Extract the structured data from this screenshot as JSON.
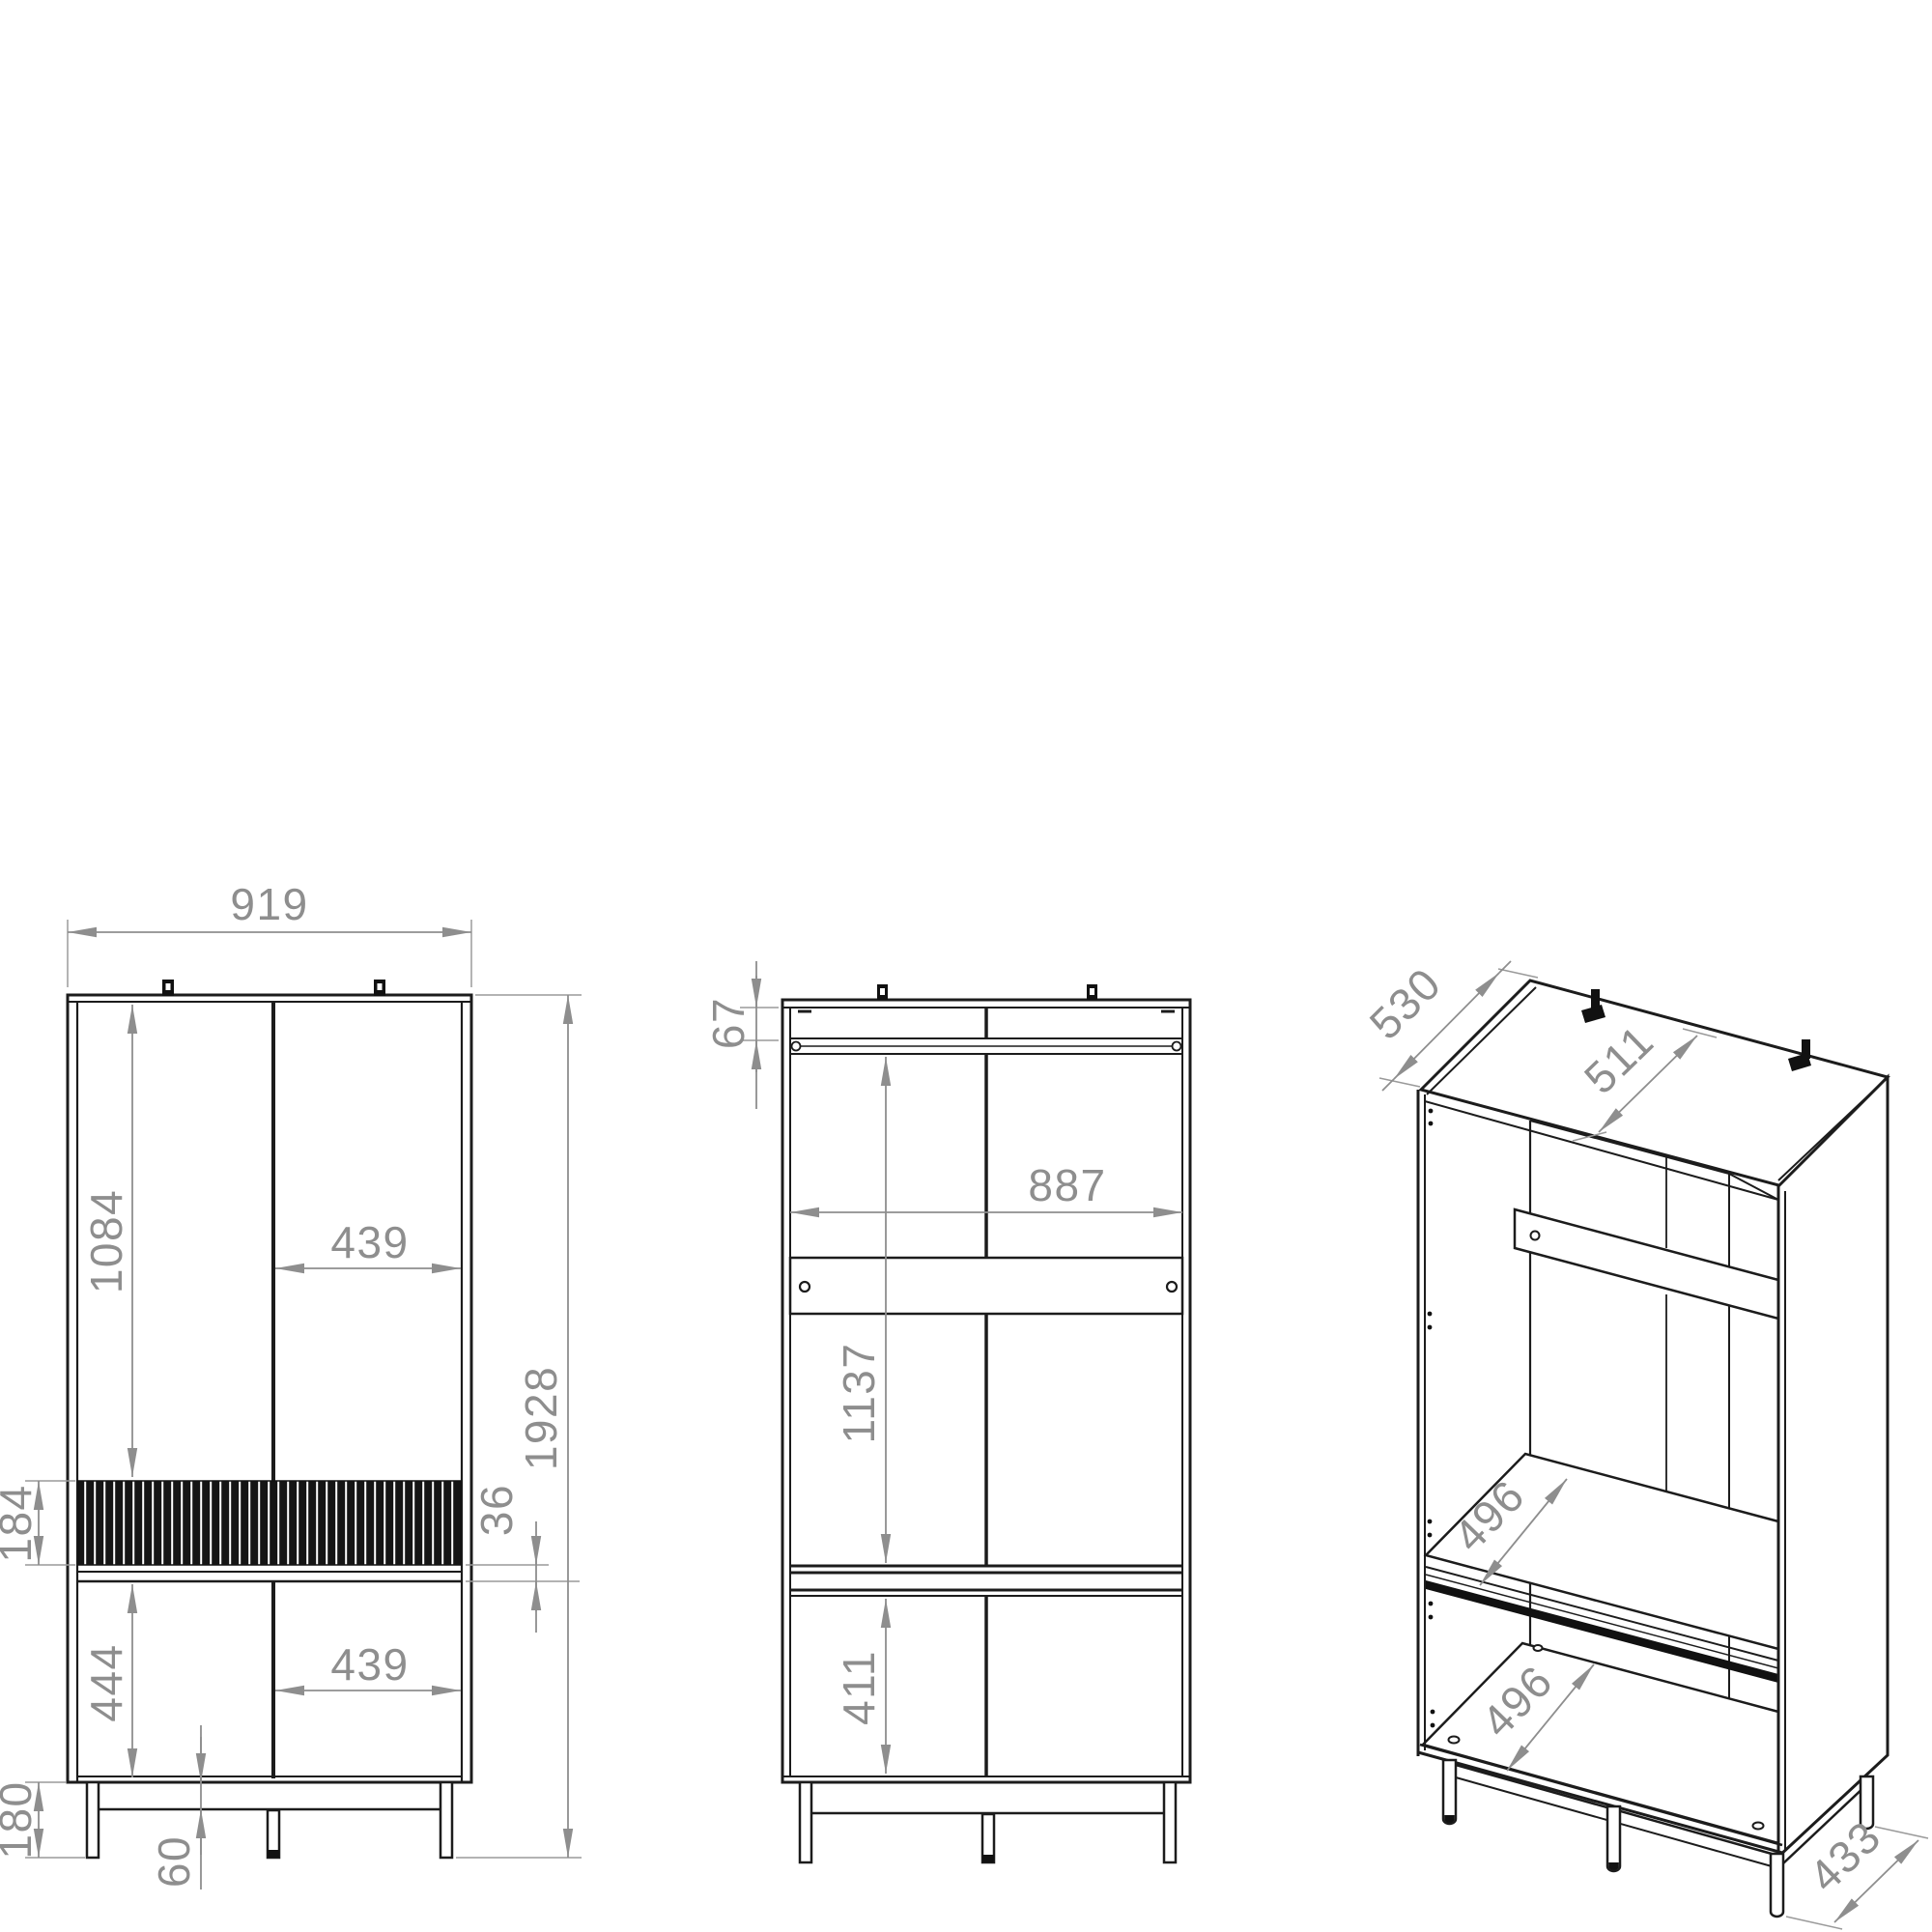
{
  "drawing": {
    "type": "furniture-technical-drawing",
    "subject": "two-door wardrobe with drawer, three orthographic/isometric views",
    "units": "mm",
    "colors": {
      "line": "#1c1c1c",
      "dimension": "#8e8e8e",
      "background": "#ffffff"
    }
  },
  "views": {
    "front_closed": {
      "label": "front view (doors closed)",
      "dims": {
        "overall_width": "919",
        "total_height": "1928",
        "upper_door_height": "1084",
        "upper_door_width": "439",
        "drawer_front_height": "184",
        "drawer_gap": "36",
        "lower_door_height": "444",
        "lower_door_width": "439",
        "leg_height": "180",
        "base_rail_height": "60"
      }
    },
    "front_open": {
      "label": "front view (carcass, doors removed)",
      "dims": {
        "top_offset": "67",
        "interior_width": "887",
        "upper_section_height": "1137",
        "lower_section_height": "411"
      }
    },
    "isometric": {
      "label": "isometric view (open carcass)",
      "dims": {
        "top_depth": "530",
        "top_interior_depth": "511",
        "upper_shelf_depth": "496",
        "lower_shelf_depth": "496",
        "base_frame_depth": "433"
      }
    }
  }
}
